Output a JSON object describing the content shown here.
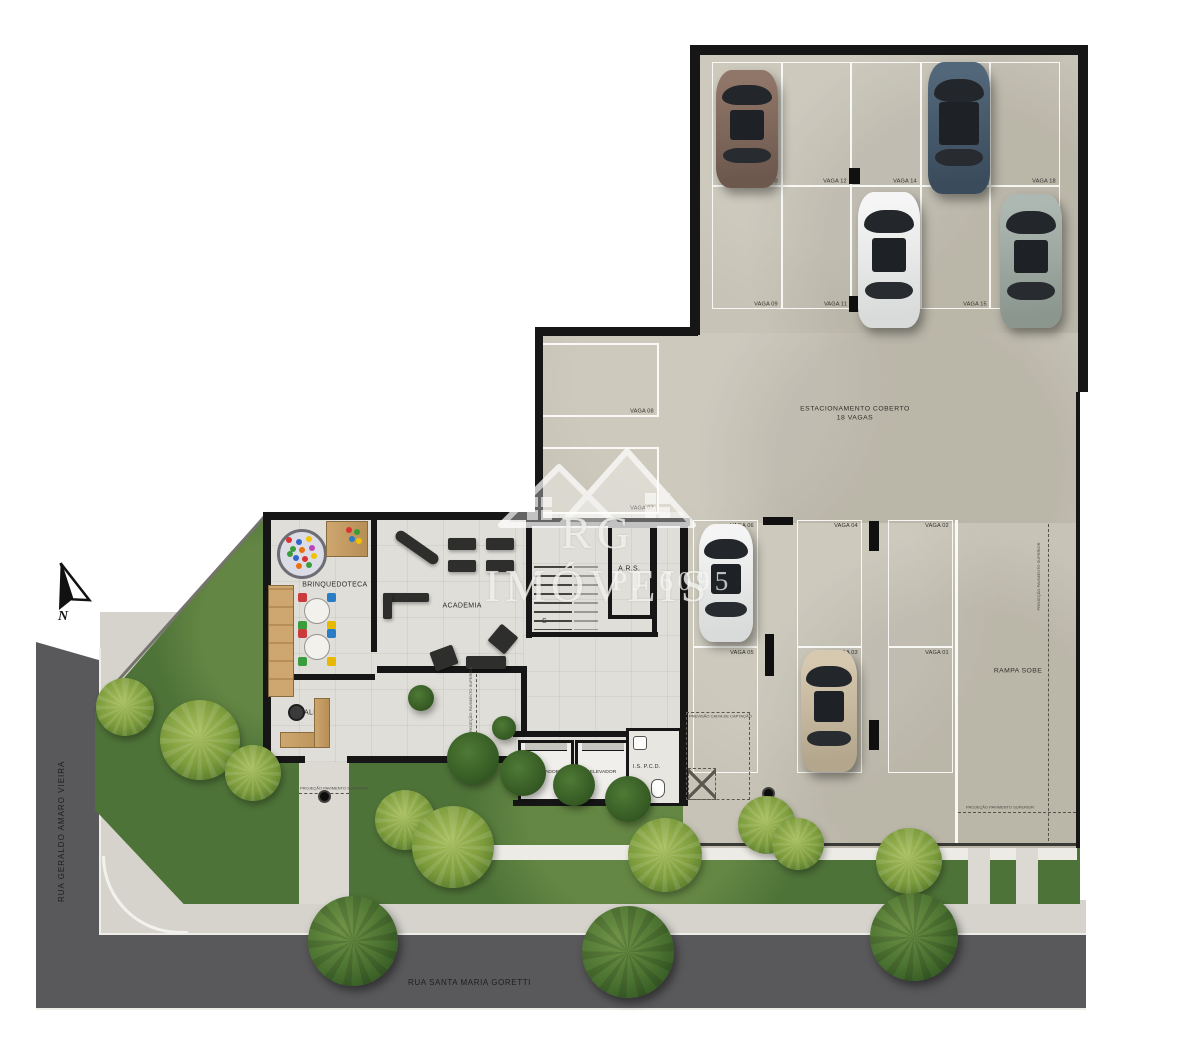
{
  "watermark": {
    "brand": "RG IMÓVEIS",
    "registration": "PJ 6095"
  },
  "compass": {
    "north": "N"
  },
  "streets": {
    "left": "RUA GERALDO AMARO VIEIRA",
    "bottom": "RUA SANTA MARIA GORETTI"
  },
  "parking": {
    "title": "ESTACIONAMENTO COBERTO",
    "subtitle": "18 VAGAS",
    "ramp": "RAMPA SOBE",
    "garage_row1": [
      "VAGA 10",
      "VAGA 12",
      "VAGA 14",
      "VAGA 16",
      "VAGA 18"
    ],
    "garage_row2": [
      "VAGA 09",
      "VAGA 11",
      "VAGA 13",
      "VAGA 15",
      "VAGA 17"
    ],
    "mid_stalls": [
      "VAGA 08",
      "VAGA 07"
    ],
    "lower_row1": [
      "VAGA 06",
      "VAGA 04",
      "VAGA 02"
    ],
    "lower_row2": [
      "VAGA 05",
      "VAGA 03",
      "VAGA 01"
    ]
  },
  "rooms": {
    "brinquedoteca": "BRINQUEDOTECA",
    "academia": "ACADEMIA",
    "hall": "HALL",
    "elevator1": "ELEVADOR",
    "elevator2": "ELEVADOR",
    "accessible_wc": "I.S. P.C.D.",
    "ars": "A.R.S.",
    "stairs": "S"
  },
  "annotations": {
    "catchbox": "PREVISÃO CAIXA DE CAPTAÇÃO",
    "upper_floor_projection": "PROJEÇÃO PAVIMENTO SUPERIOR"
  },
  "colors": {
    "asphalt": "#59595b",
    "sidewalk": "#d5d3cc",
    "grass": "#4e7338",
    "concrete": "#c7c3b6",
    "interior_floor": "#e0ded8",
    "wall": "#161616",
    "wood": "#c29a66",
    "stall_line": "#ffffff",
    "car_brown": "#7d655a",
    "car_blue": "#46586b",
    "car_white": "#f0f1f0",
    "car_silver": "#9aa59f",
    "car_beige": "#cfc2a8"
  }
}
